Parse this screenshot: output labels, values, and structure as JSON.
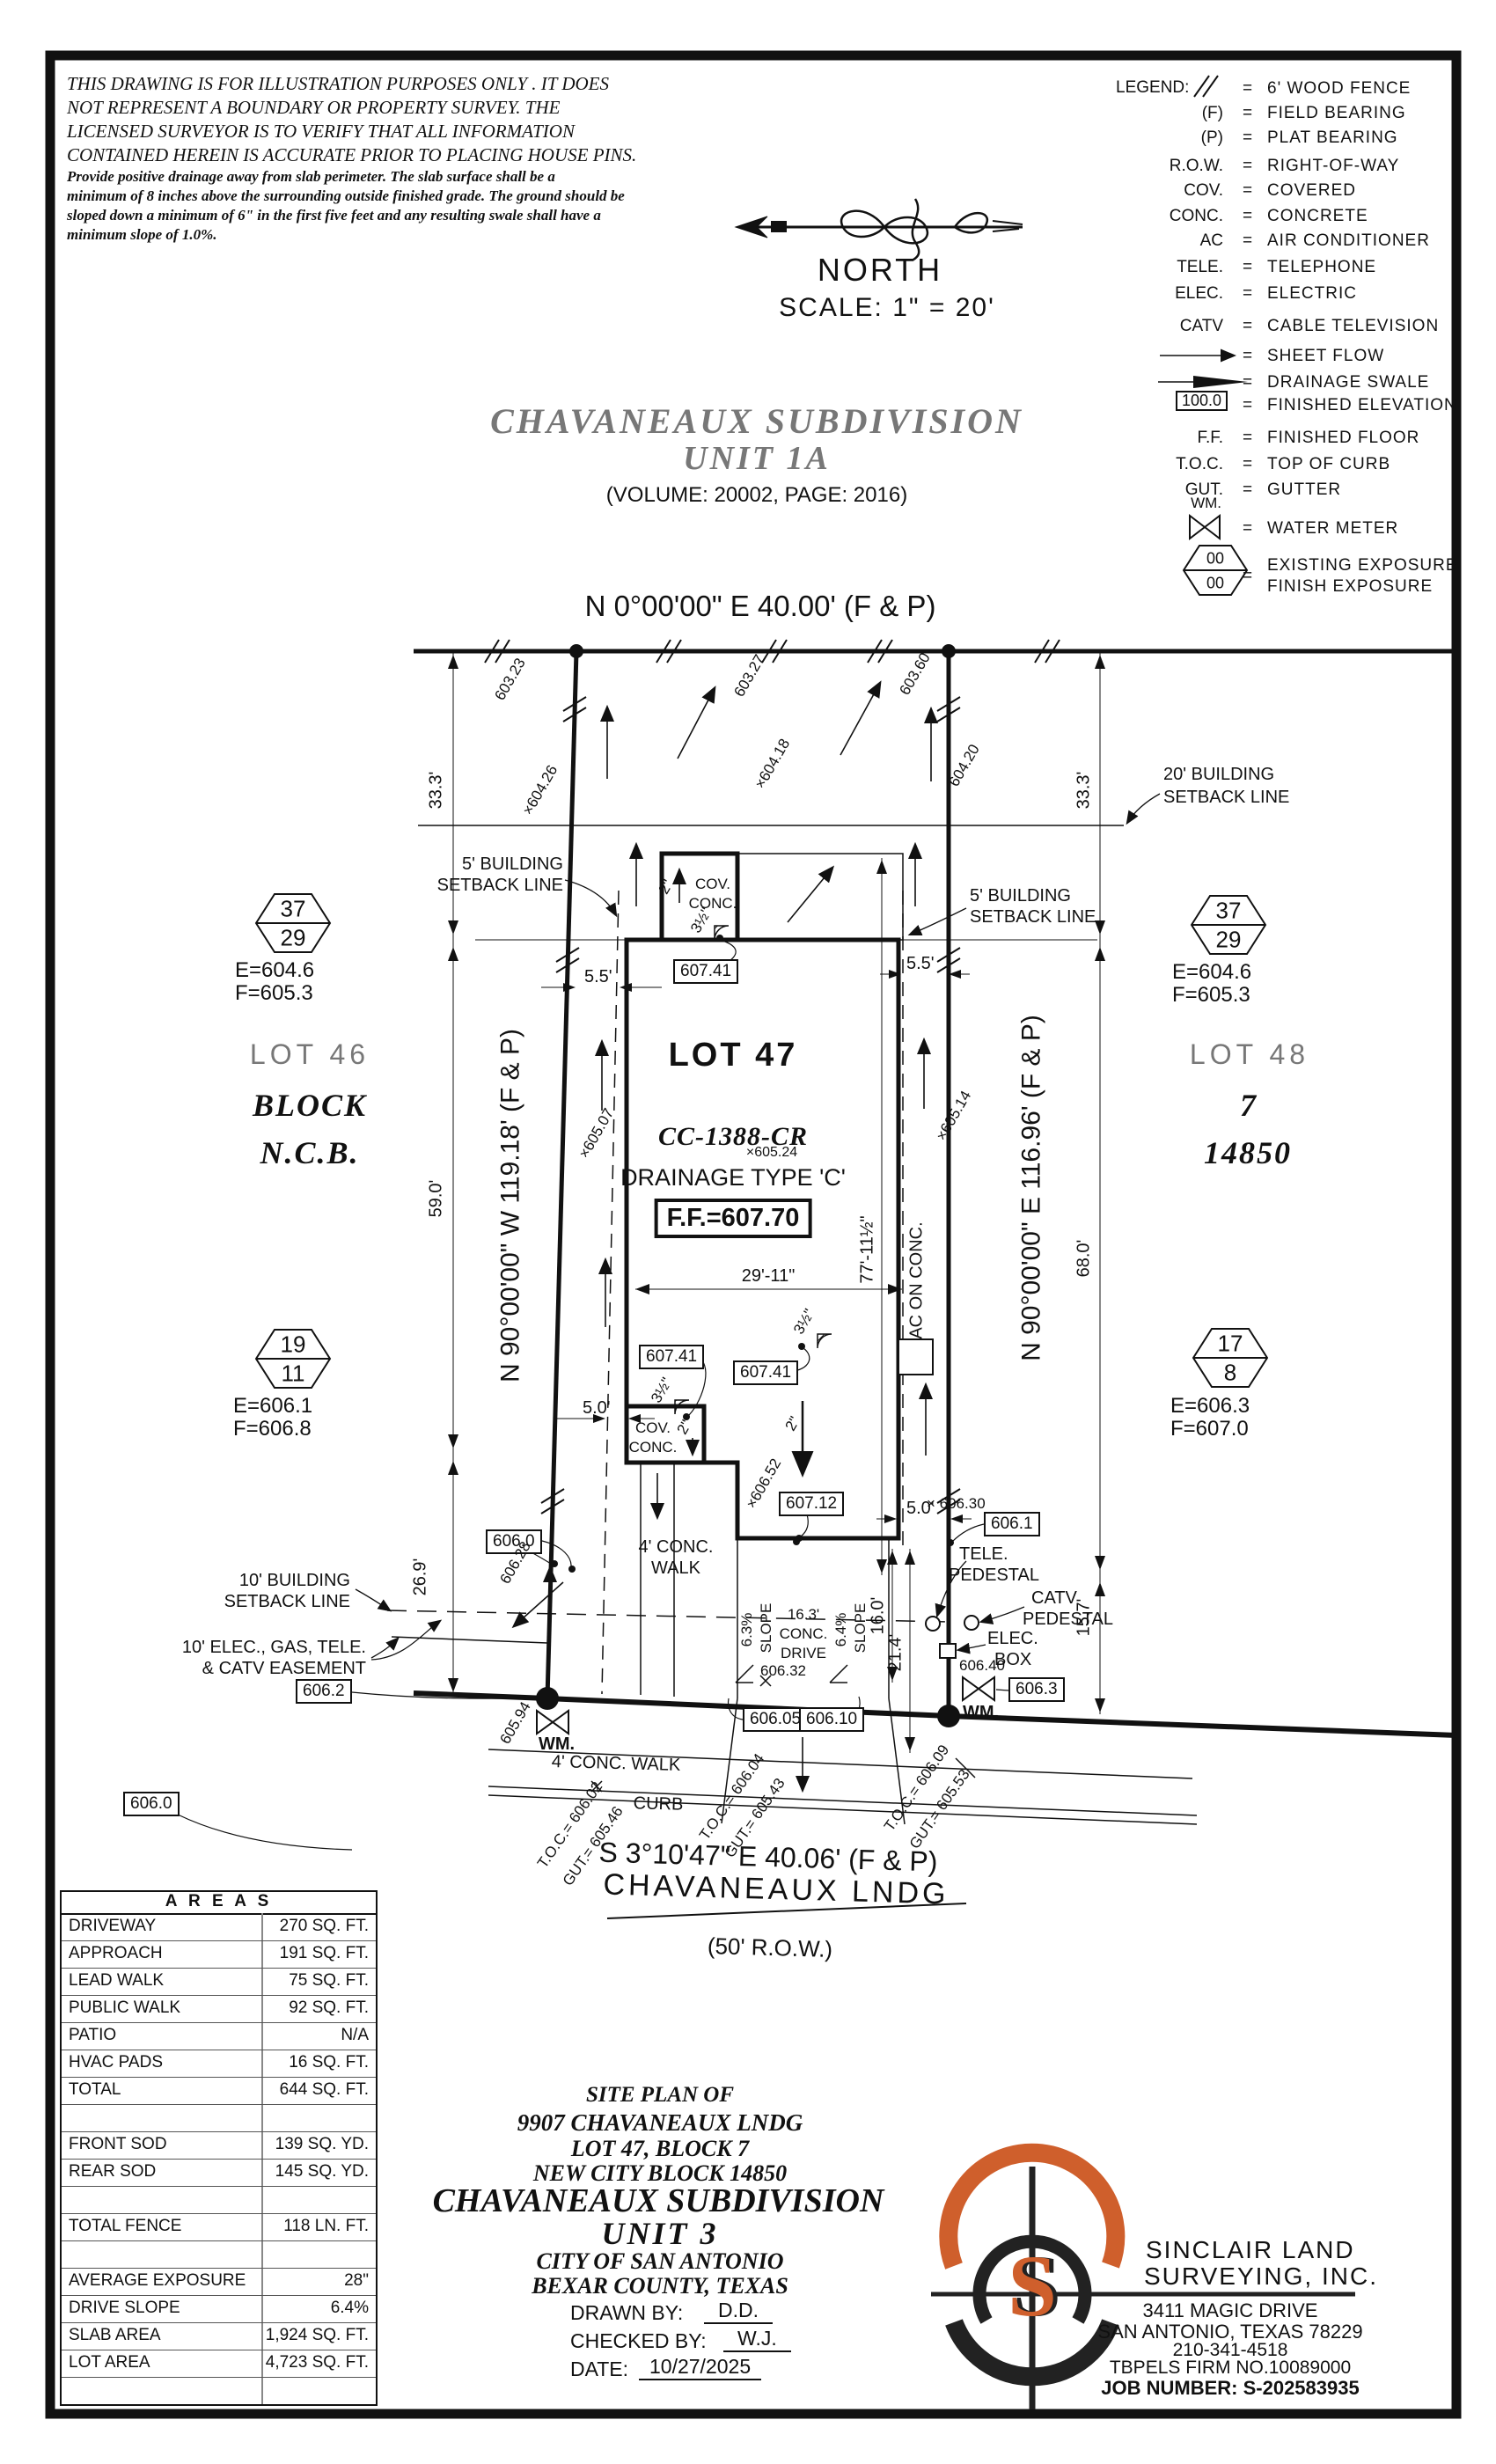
{
  "disclaimer": {
    "l1": "THIS DRAWING IS FOR ILLUSTRATION PURPOSES ONLY . IT DOES",
    "l2": "NOT REPRESENT A BOUNDARY OR PROPERTY SURVEY. THE",
    "l3": "LICENSED SURVEYOR IS TO VERIFY THAT ALL INFORMATION",
    "l4": "CONTAINED HEREIN IS ACCURATE PRIOR TO PLACING HOUSE PINS.",
    "l5": "Provide positive drainage away from slab perimeter. The slab surface shall be a",
    "l6": "minimum of 8 inches above the surrounding outside finished grade. The ground should be",
    "l7": "sloped down a minimum of 6\" in the first five feet and any resulting swale shall have a",
    "l8": "minimum slope of 1.0%."
  },
  "compass": {
    "north": "NORTH",
    "scale": "SCALE: 1\" = 20'"
  },
  "legend": {
    "title": "LEGEND:",
    "eq": "=",
    "fe_val": "100.0",
    "rows": [
      {
        "a": "",
        "d": "6' WOOD FENCE"
      },
      {
        "a": "(F)",
        "d": "FIELD BEARING"
      },
      {
        "a": "(P)",
        "d": "PLAT BEARING"
      },
      {
        "a": "R.O.W.",
        "d": "RIGHT-OF-WAY"
      },
      {
        "a": "COV.",
        "d": "COVERED"
      },
      {
        "a": "CONC.",
        "d": "CONCRETE"
      },
      {
        "a": "AC",
        "d": "AIR CONDITIONER"
      },
      {
        "a": "TELE.",
        "d": "TELEPHONE"
      },
      {
        "a": "ELEC.",
        "d": "ELECTRIC"
      },
      {
        "a": "CATV",
        "d": "CABLE TELEVISION"
      },
      {
        "a": "",
        "d": "SHEET FLOW"
      },
      {
        "a": "",
        "d": "DRAINAGE SWALE"
      },
      {
        "a": "",
        "d": "FINISHED ELEVATION"
      },
      {
        "a": "F.F.",
        "d": "FINISHED FLOOR"
      },
      {
        "a": "T.O.C.",
        "d": "TOP OF CURB"
      },
      {
        "a": "GUT.",
        "d": "GUTTER"
      },
      {
        "a": "WM.",
        "d": "WATER METER"
      }
    ],
    "exposure": {
      "top": "00",
      "bottom": "00",
      "d1": "EXISTING EXPOSURE",
      "d2": "FINISH EXPOSURE"
    }
  },
  "title": {
    "l1": "CHAVANEAUX SUBDIVISION",
    "l2": "UNIT 1A",
    "vol": "(VOLUME: 20002, PAGE: 2016)"
  },
  "plat": {
    "bearing_top": "N 0°00'00\" E 40.00' (F & P)",
    "bearing_bottom": "S 3°10'47\" E 40.06' (F & P)",
    "bearing_left": "N 90°00'00\" W 119.18' (F & P)",
    "bearing_right": "N 90°00'00\" E 116.96' (F & P)",
    "street": "CHAVANEAUX LNDG",
    "row": "(50' R.O.W.)",
    "lot46": "LOT 46",
    "lot47": "LOT 47",
    "lot48": "LOT 48",
    "block_l": "BLOCK",
    "block_r": "7",
    "ncb_l": "N.C.B.",
    "ncb_r": "14850",
    "cc": "CC-1388-CR",
    "spot_cc": "×605.24",
    "drainage": "DRAINAGE TYPE 'C'",
    "ff": "F.F.=607.70",
    "hex": {
      "tl": {
        "a": "37",
        "b": "29",
        "e": "E=604.6",
        "f": "F=605.3"
      },
      "tr": {
        "a": "37",
        "b": "29",
        "e": "E=604.6",
        "f": "F=605.3"
      },
      "bl": {
        "a": "19",
        "b": "11",
        "e": "E=606.1",
        "f": "F=606.8"
      },
      "br": {
        "a": "17",
        "b": "8",
        "e": "E=606.3",
        "f": "F=607.0"
      }
    },
    "setback5_1": "5' BUILDING",
    "setback5_2": "SETBACK LINE",
    "setback20_1": "20' BUILDING",
    "setback20_2": "SETBACK LINE",
    "setback10_1": "10' BUILDING",
    "setback10_2": "SETBACK LINE",
    "easement_1": "10' ELEC., GAS, TELE.",
    "easement_2": "& CATV EASEMENT",
    "cov": "COV.",
    "conc": "CONC.",
    "walk4_1": "4' CONC.",
    "walk4_2": "WALK",
    "walk4_street": "4' CONC. WALK",
    "curb": "CURB",
    "ac": "AC ON CONC.",
    "tele1": "TELE.",
    "tele2": "PEDESTAL",
    "catv1": "CATV",
    "catv2": "PEDESTAL",
    "elec1": "ELEC.",
    "elec2": "BOX",
    "wm": "WM.",
    "drive1": "16.3'",
    "drive2": "CONC.",
    "drive3": "DRIVE",
    "slope1": "6.3%",
    "slope2": "6.4%",
    "slope_w": "SLOPE",
    "dims": {
      "d333": "33.3'",
      "d590": "59.0'",
      "d269": "26.9'",
      "d680": "68.0'",
      "d157": "15.7'",
      "d160": "16.0'",
      "d214": "21.4'",
      "d55": "5.5'",
      "d50": "5.0'",
      "d2911": "29'-11\"",
      "d7711": "77'-11½\"",
      "d2": "2\"",
      "d35": "3½\""
    },
    "boxes": {
      "b60741": "607.41",
      "b60712": "607.12",
      "b6060": "606.0",
      "b6062": "606.2",
      "b6061": "606.1",
      "b6063": "606.3",
      "b60605": "606.05",
      "b60610": "606.10"
    },
    "spots": {
      "s60323": "603.23",
      "s60327": "603.27",
      "s60360": "603.60",
      "s60426": "×604.26",
      "s60418": "×604.18",
      "s60420": "604.20",
      "s60507": "×605.07",
      "s60514": "×605.14",
      "s60652": "×606.52",
      "s60628": "606.28",
      "s60594": "605.94",
      "s60630": "× 606.30",
      "s60640": "606.40",
      "s60632": "606.32"
    },
    "toc": {
      "t1a": "T.O.C.= 606.02",
      "t1b": "GUT.= 605.46",
      "t2a": "T.O.C.= 606.04",
      "t2b": "GUT.= 605.43",
      "t3a": "T.O.C.= 606.09",
      "t3b": "GUT.= 605.53"
    }
  },
  "areas": {
    "title": "A R E A S",
    "rows": [
      {
        "l": "DRIVEWAY",
        "v": "270 SQ. FT."
      },
      {
        "l": "APPROACH",
        "v": "191 SQ. FT."
      },
      {
        "l": "LEAD WALK",
        "v": "75 SQ. FT."
      },
      {
        "l": "PUBLIC WALK",
        "v": "92 SQ. FT."
      },
      {
        "l": "PATIO",
        "v": "N/A"
      },
      {
        "l": "HVAC PADS",
        "v": "16 SQ. FT."
      },
      {
        "l": "TOTAL",
        "v": "644 SQ. FT."
      },
      {
        "l": "",
        "v": ""
      },
      {
        "l": "FRONT SOD",
        "v": "139 SQ. YD."
      },
      {
        "l": "REAR SOD",
        "v": "145 SQ. YD."
      },
      {
        "l": "",
        "v": ""
      },
      {
        "l": "TOTAL FENCE",
        "v": "118 LN. FT."
      },
      {
        "l": "",
        "v": ""
      },
      {
        "l": "AVERAGE EXPOSURE",
        "v": "28\""
      },
      {
        "l": "DRIVE SLOPE",
        "v": "6.4%"
      },
      {
        "l": "SLAB AREA",
        "v": "1,924 SQ. FT."
      },
      {
        "l": "LOT AREA",
        "v": "4,723 SQ. FT."
      },
      {
        "l": "",
        "v": ""
      }
    ]
  },
  "siteinfo": {
    "l1": "SITE PLAN OF",
    "l2": "9907 CHAVANEAUX LNDG",
    "l3": "LOT 47, BLOCK 7",
    "l4": "NEW CITY BLOCK 14850",
    "l5": "CHAVANEAUX SUBDIVISION",
    "l6": "UNIT 3",
    "l7": "CITY OF SAN ANTONIO",
    "l8": "BEXAR COUNTY, TEXAS",
    "drawn_label": "DRAWN BY:",
    "drawn": "D.D.",
    "checked_label": "CHECKED BY:",
    "checked": "W.J.",
    "date_label": "DATE:",
    "date": "10/27/2025"
  },
  "firm": {
    "logo_letter": "S",
    "name1": "SINCLAIR LAND",
    "name2": "SURVEYING, INC.",
    "addr1": "3411 MAGIC DRIVE",
    "addr2": "SAN ANTONIO, TEXAS 78229",
    "phone": "210-341-4518",
    "tbpels": "TBPELS FIRM NO.10089000",
    "job": "JOB NUMBER: S-202583935"
  }
}
